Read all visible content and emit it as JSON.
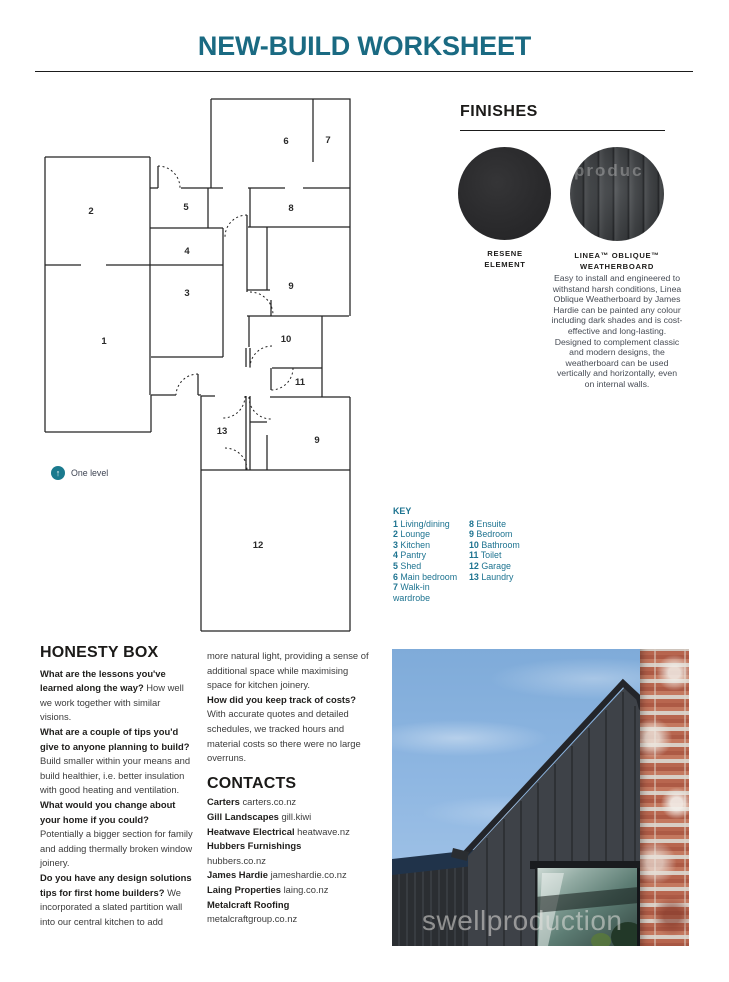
{
  "page": {
    "title": "NEW-BUILD WORKSHEET"
  },
  "colors": {
    "title_teal": "#1a6a82",
    "key_teal": "#1d7390",
    "one_level_badge": "#1a7a8e",
    "heading_black": "#1b1a18",
    "body_gray": "#3c3c3c",
    "sky_blue": "#8fb7e2",
    "house_charcoal": "#3e4248",
    "brick_red": "#b8664f"
  },
  "plan": {
    "note_label": "One level",
    "room_numbers": [
      "1",
      "2",
      "3",
      "4",
      "5",
      "6",
      "7",
      "8",
      "9",
      "10",
      "11",
      "12",
      "13",
      "9"
    ]
  },
  "key": {
    "heading": "KEY",
    "col1": [
      {
        "n": "1",
        "label": "Living/dining"
      },
      {
        "n": "2",
        "label": "Lounge"
      },
      {
        "n": "3",
        "label": "Kitchen"
      },
      {
        "n": "4",
        "label": "Pantry"
      },
      {
        "n": "5",
        "label": "Shed"
      },
      {
        "n": "6",
        "label": "Main bedroom"
      },
      {
        "n": "7",
        "label": "Walk-in wardrobe"
      }
    ],
    "col2": [
      {
        "n": "8",
        "label": "Ensuite"
      },
      {
        "n": "9",
        "label": "Bedroom"
      },
      {
        "n": "10",
        "label": "Bathroom"
      },
      {
        "n": "11",
        "label": "Toilet"
      },
      {
        "n": "12",
        "label": "Garage"
      },
      {
        "n": "13",
        "label": "Laundry"
      }
    ]
  },
  "finishes": {
    "heading": "FINISHES",
    "swatch1": {
      "label_line1": "RESENE",
      "label_line2": "ELEMENT"
    },
    "swatch2": {
      "label_line1": "LINEA™ OBLIQUE™",
      "label_line2": "WEATHERBOARD",
      "watermark": "produc",
      "description": "Easy to install and engineered to withstand harsh conditions, Linea Oblique Weatherboard by James Hardie can be painted any colour including dark shades and is cost-effective and long-lasting. Designed to complement classic and modern designs, the weatherboard can be used vertically and horizontally, even on internal walls."
    }
  },
  "honesty": {
    "heading": "HONESTY BOX",
    "col1": [
      {
        "q": "What are the lessons you've learned along the way?",
        "a": "How well we work together with similar visions."
      },
      {
        "q": "What are a couple of tips you'd give to anyone planning to build?",
        "a": "Build smaller within your means and build healthier, i.e. better insulation with good heating and ventilation."
      },
      {
        "q": "What would you change about your home if you could?",
        "a": "Potentially a bigger section for family and adding thermally broken window joinery."
      },
      {
        "q": "Do you have any design solutions tips for first home builders?",
        "a": "We incorporated a slated partition wall into our central kitchen to add"
      }
    ],
    "col2": [
      {
        "a": "more natural light, providing a sense of additional space while maximising space for kitchen joinery."
      },
      {
        "q": "How did you keep track of costs?",
        "a": "With accurate quotes and detailed schedules, we tracked hours and material costs so there were no large overruns."
      }
    ]
  },
  "contacts": {
    "heading": "CONTACTS",
    "items": [
      {
        "name": "Carters",
        "detail": "carters.co.nz"
      },
      {
        "name": "Gill Landscapes",
        "detail": "gill.kiwi"
      },
      {
        "name": "Heatwave Electrical",
        "detail": "heatwave.nz"
      },
      {
        "name": "Hubbers Furnishings",
        "detail": "hubbers.co.nz"
      },
      {
        "name": "James Hardie",
        "detail": "jameshardie.co.nz"
      },
      {
        "name": "Laing Properties",
        "detail": "laing.co.nz"
      },
      {
        "name": "Metalcraft Roofing",
        "detail": "metalcraftgroup.co.nz"
      }
    ]
  },
  "photo": {
    "watermark": "swellproduction"
  }
}
